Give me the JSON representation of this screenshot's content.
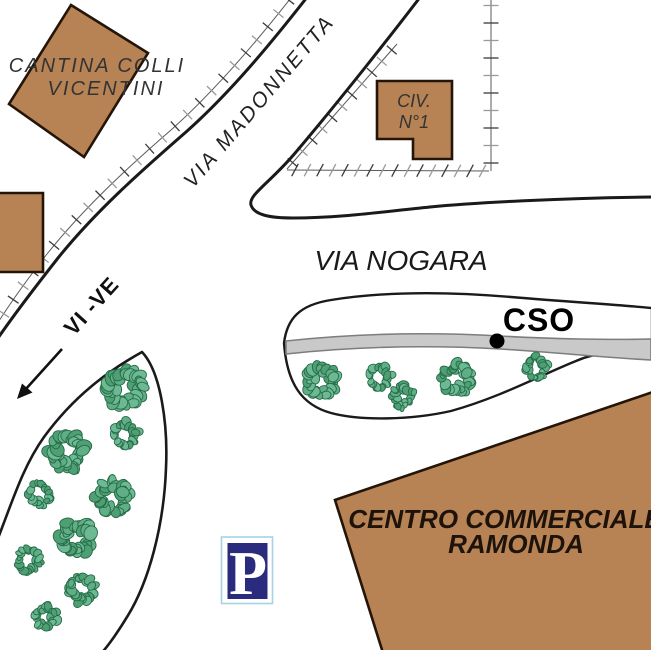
{
  "map": {
    "labels": {
      "cantina": {
        "line1": "CANTINA COLLI",
        "line2": "VICENTINI"
      },
      "via_madonnetta": "VIA MADONNETTA",
      "civ": {
        "line1": "CIV.",
        "line2": "N°1"
      },
      "via_nogara": "VIA NOGARA",
      "direction_sign": "VI -VE",
      "cso": "CSO",
      "centro": {
        "line1": "CENTRO COMMERCIALE",
        "line2": "RAMONDA"
      },
      "parking": "P"
    },
    "colors": {
      "building_fill": "#b78355",
      "building_border": "#241508",
      "road_line": "#1a1a1a",
      "street_band_fill": "#c9c9c9",
      "street_band_border": "#7d7d7d",
      "tree_fill": "#58a87e",
      "tree_stroke": "#256b47",
      "parking_bg": "#2b2b7e",
      "parking_border": "#a5d2e4",
      "label_color": "#333333"
    },
    "features": {
      "cso_marker": {
        "x": 497,
        "y": 341,
        "r": 7.5
      },
      "trees_roadside": [
        [
          322,
          381,
          17
        ],
        [
          380,
          377,
          13
        ],
        [
          403,
          396,
          13
        ],
        [
          457,
          378,
          17
        ],
        [
          536,
          367,
          13
        ]
      ],
      "trees_parking_grove": [
        [
          125,
          388,
          20
        ],
        [
          126,
          434,
          14
        ],
        [
          67,
          452,
          20
        ],
        [
          40,
          494,
          13
        ],
        [
          112,
          497,
          19
        ],
        [
          76,
          538,
          19
        ],
        [
          28,
          560,
          13
        ],
        [
          82,
          589,
          15
        ],
        [
          46,
          616,
          13
        ]
      ]
    }
  }
}
